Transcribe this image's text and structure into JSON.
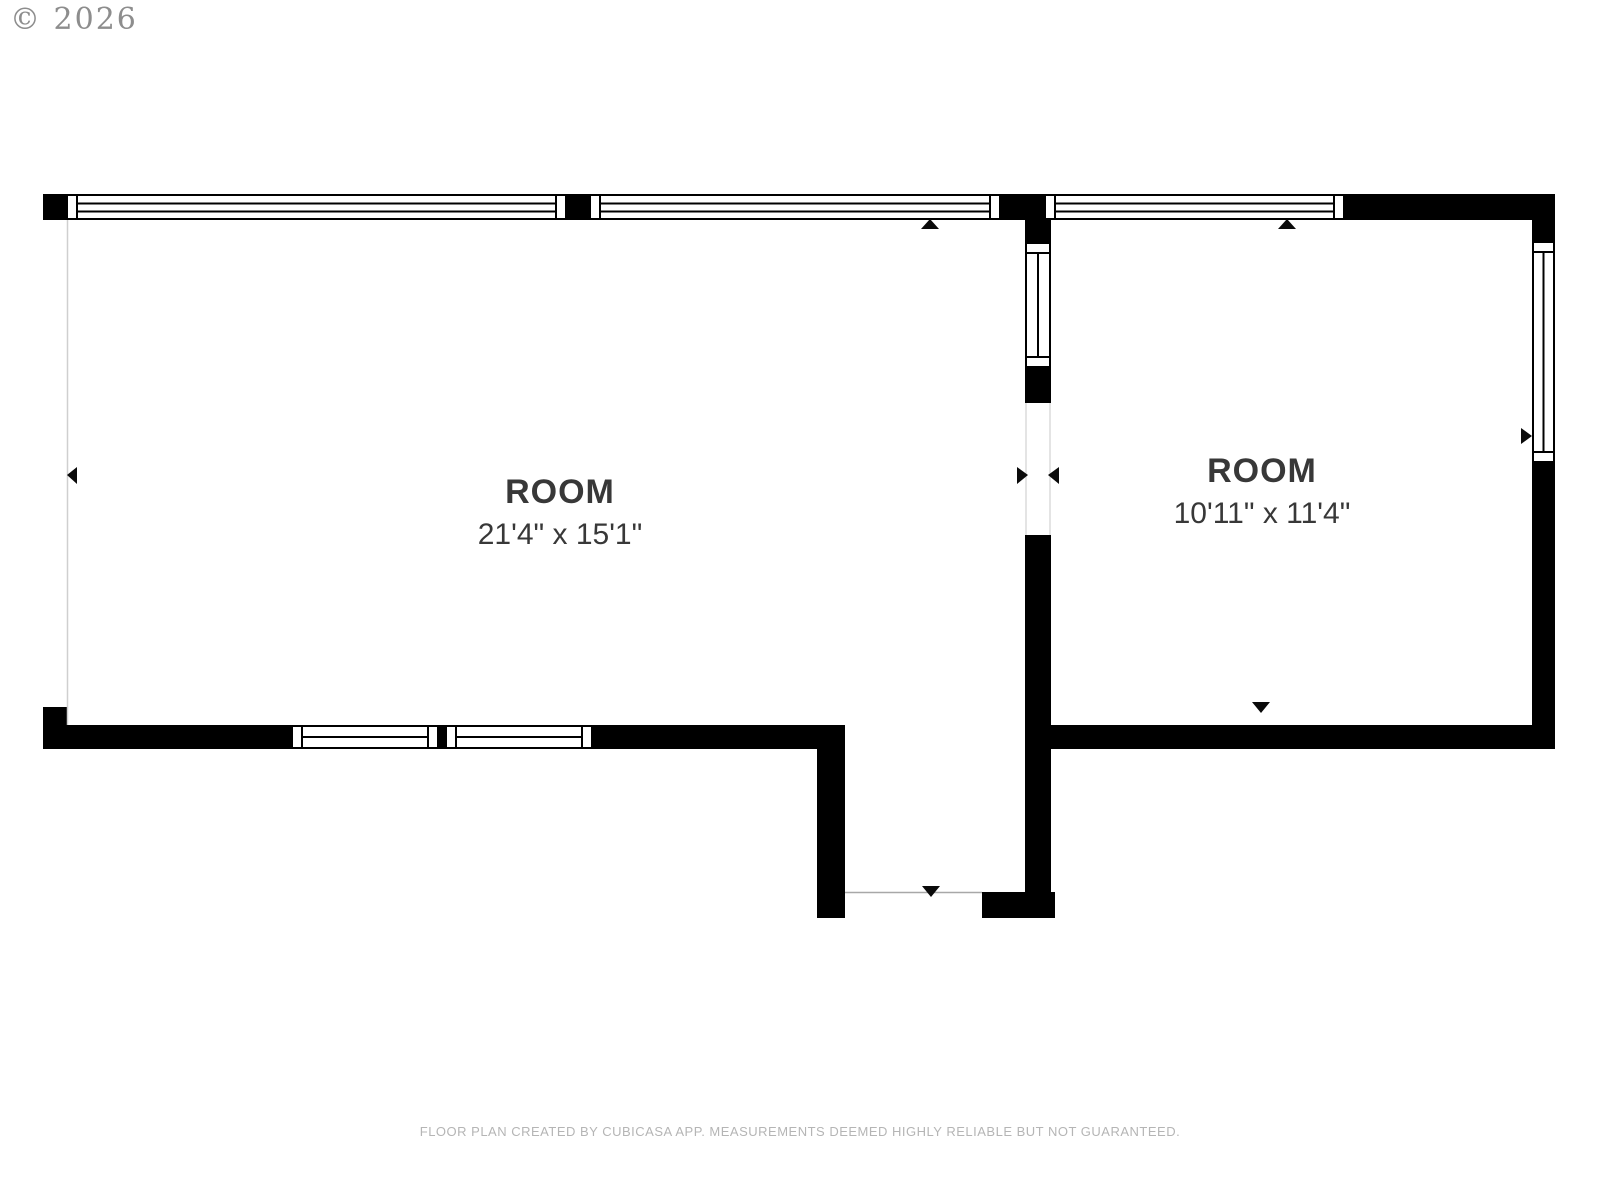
{
  "page": {
    "copyright": "© 2026",
    "footer": "FLOOR PLAN CREATED BY CUBICASA APP. MEASUREMENTS DEEMED HIGHLY RELIABLE BUT NOT GUARANTEED."
  },
  "floor_plan": {
    "rooms": [
      {
        "name": "ROOM",
        "dimensions": "21'4\" x 15'1\""
      },
      {
        "name": "ROOM",
        "dimensions": "10'11\" x 11'4\""
      }
    ],
    "colors": {
      "wall": "#000000",
      "background": "#ffffff",
      "label_text": "#383838",
      "copyright_text": "#8d8d8d",
      "footer_text": "#b5b5b5"
    }
  }
}
